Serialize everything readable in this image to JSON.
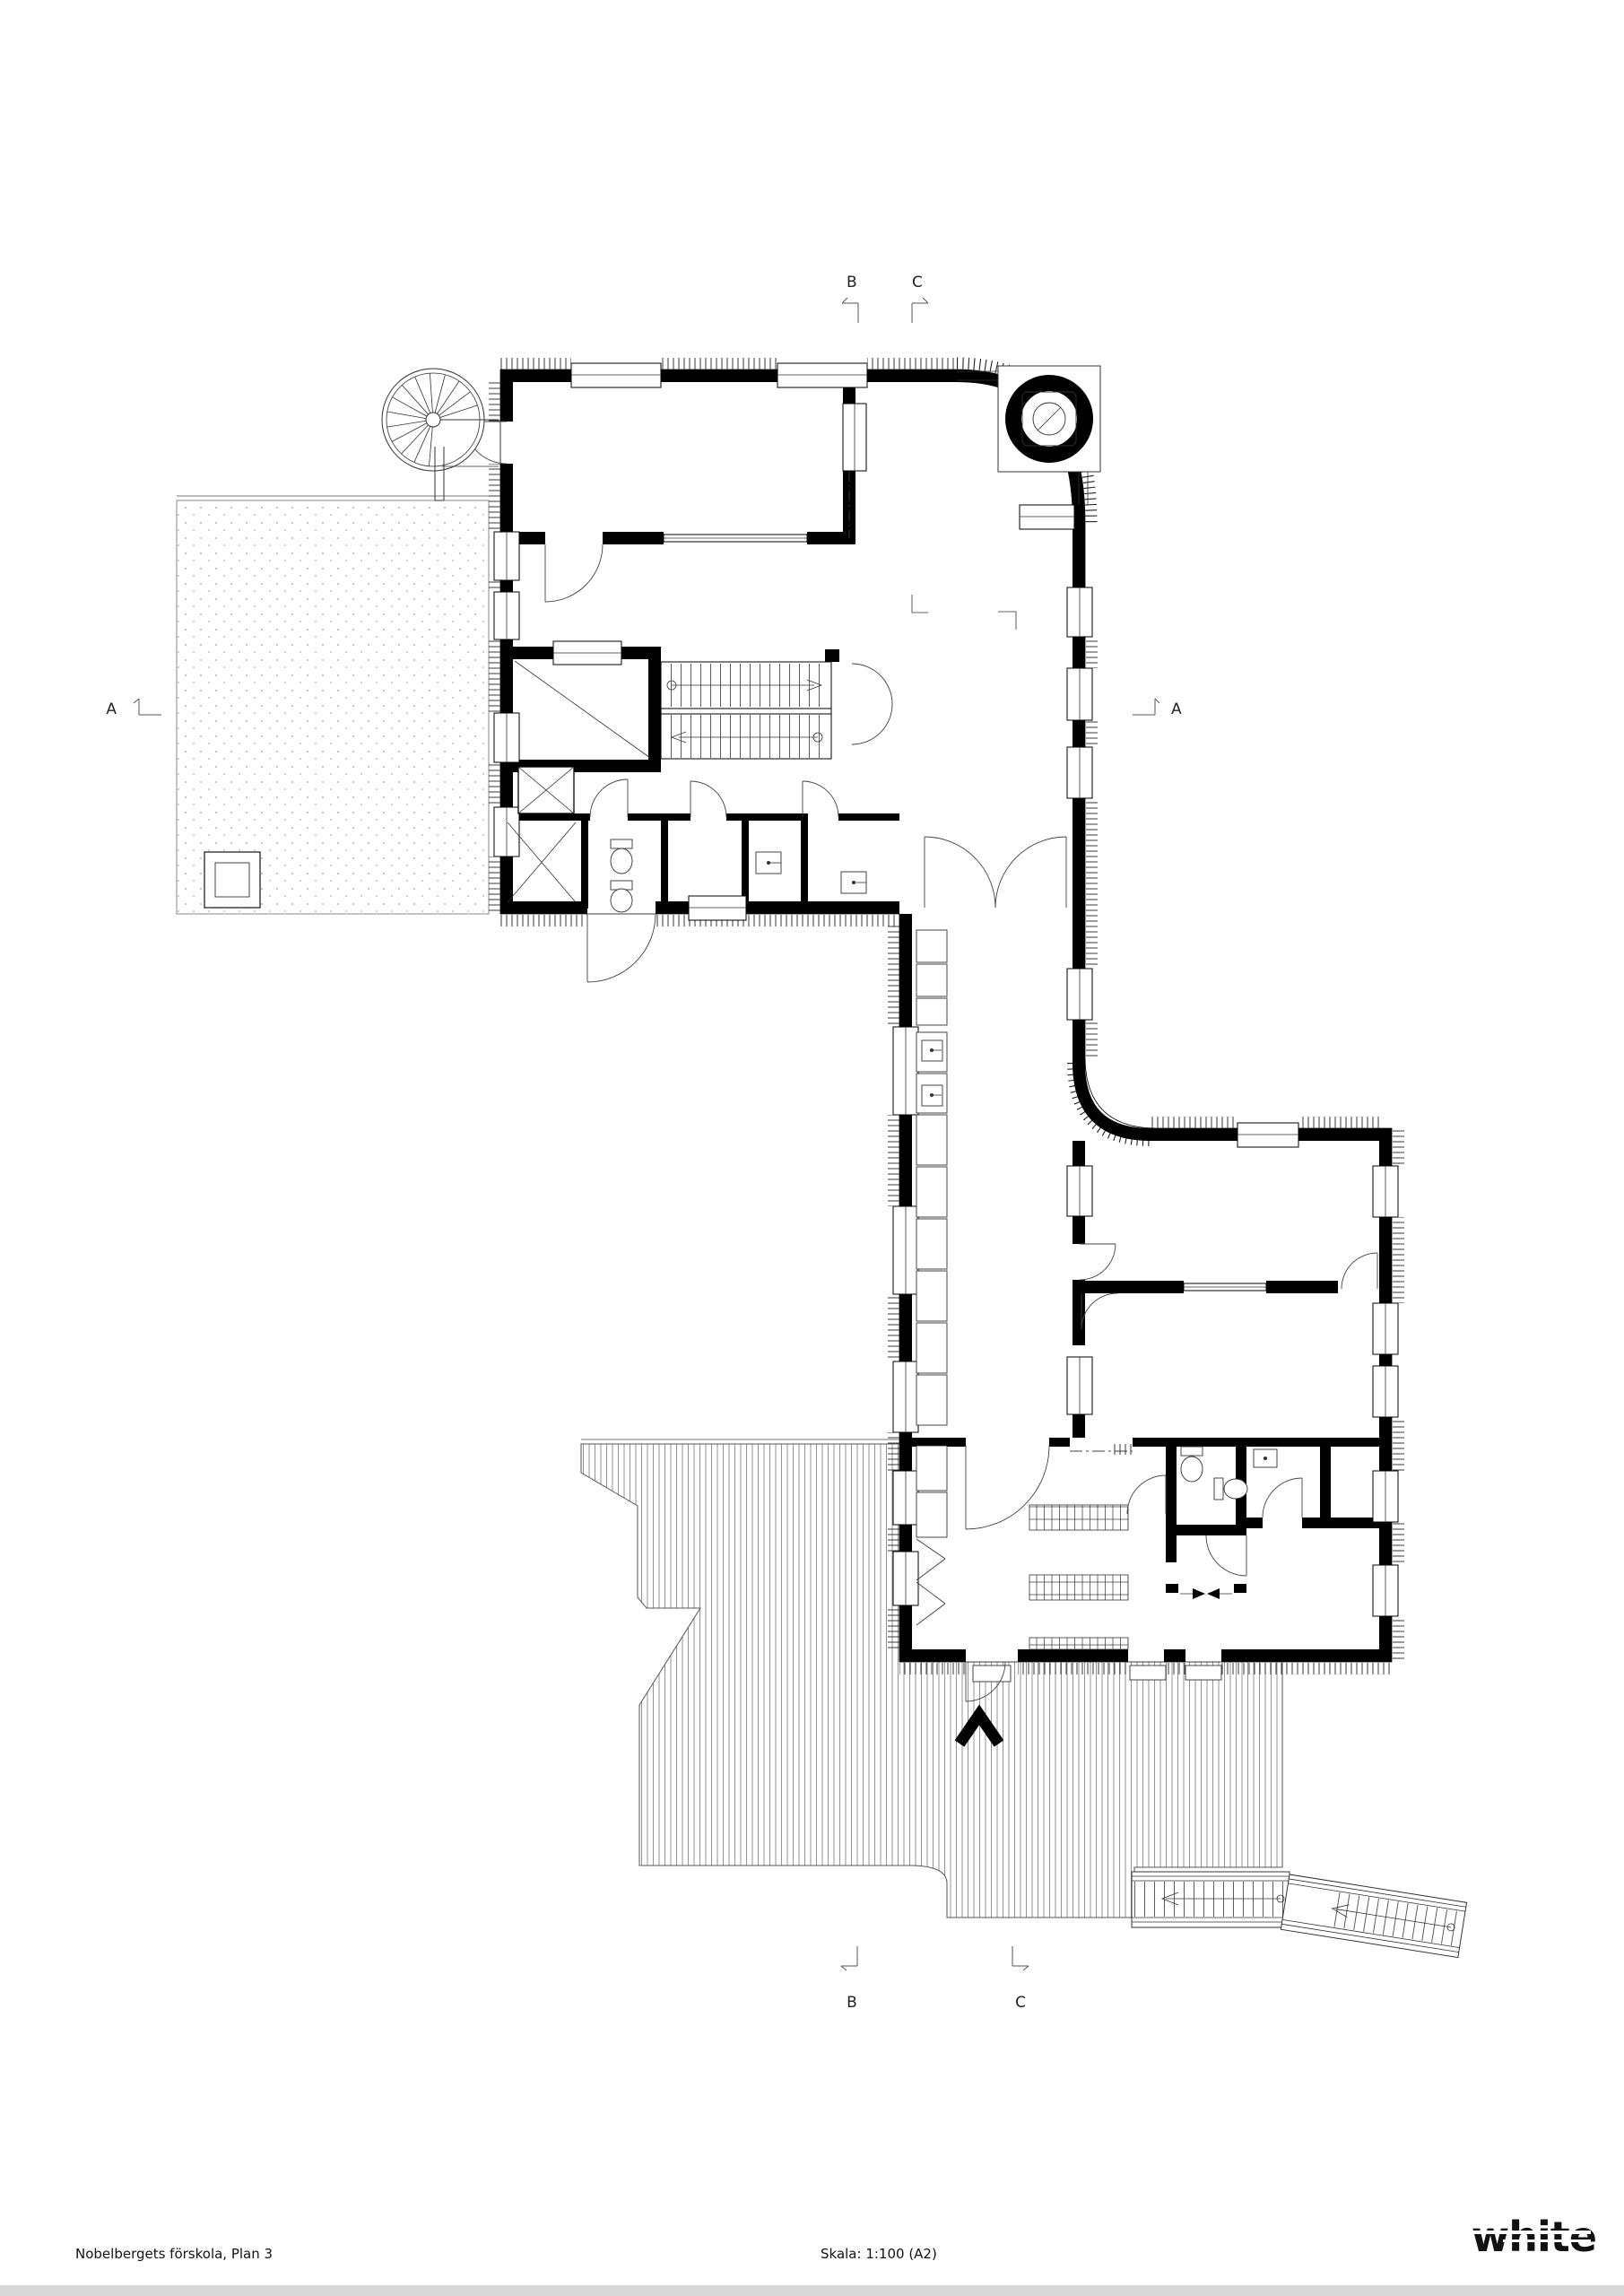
{
  "titleblock": {
    "title": "Nobelbergets förskola, Plan 3",
    "scale": "Skala: 1:100 (A2)",
    "logo": "white"
  },
  "section_markers": {
    "left_a": "A",
    "right_a": "A",
    "top_b": "B",
    "top_c": "C",
    "bottom_b": "B",
    "bottom_c": "C"
  },
  "drawing": {
    "ink_color": "#000000",
    "hatch_color": "#666666",
    "dot_color": "#9a9a9a",
    "footer_bar_color": "#d8d8d8",
    "plan_type": "architectural floor plan",
    "features": [
      "spiral-stair",
      "roof-terrace",
      "straight-stair",
      "elevator",
      "wc-rooms",
      "corridor",
      "entry-deck",
      "exterior-ramp",
      "turret-circle"
    ]
  }
}
